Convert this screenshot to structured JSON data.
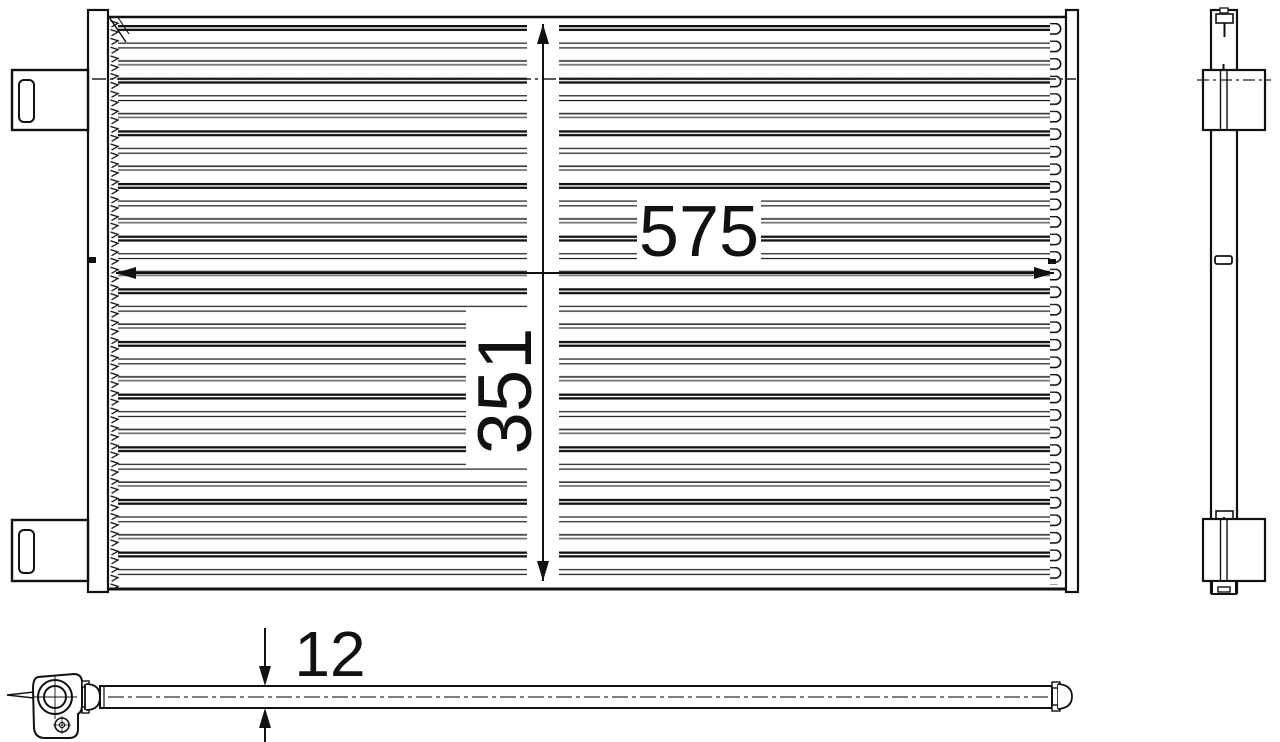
{
  "drawing": {
    "colors": {
      "background": "#ffffff",
      "line": "#1a1a1a"
    },
    "dimensions": {
      "width": "575",
      "height": "351",
      "depth": "12"
    }
  }
}
